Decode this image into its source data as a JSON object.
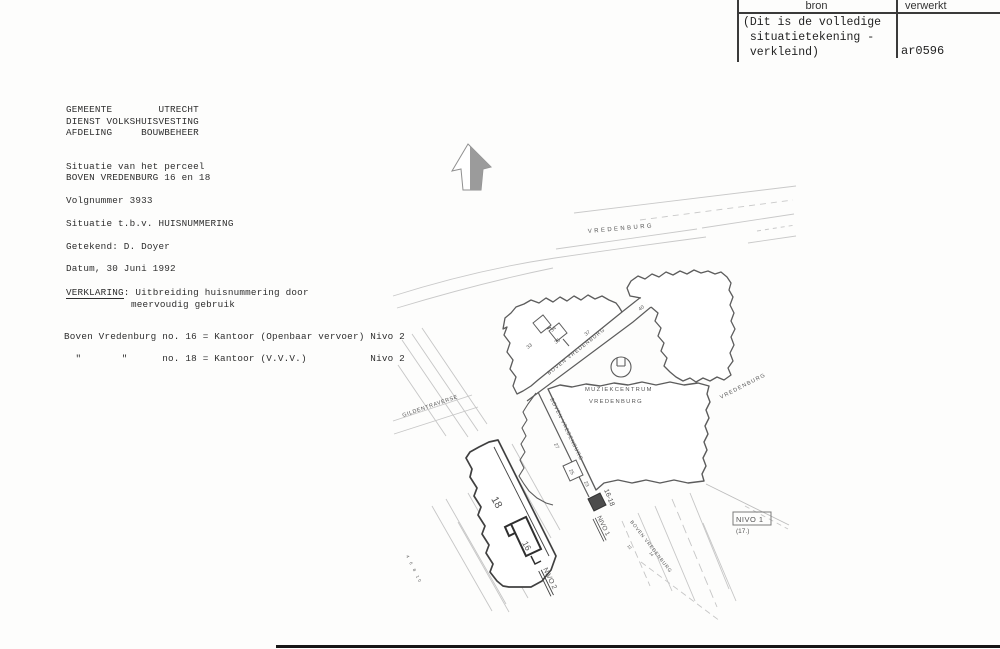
{
  "stamp": {
    "col1": "bron",
    "col2": "verwerkt",
    "note1": "(Dit is de volledige",
    "note2": " situatietekening -",
    "note3": " verkleind)",
    "code": "ar0596"
  },
  "text": {
    "lh1": "GEMEENTE        UTRECHT",
    "lh2": "DIENST VOLKSHUISVESTING",
    "lh3": "AFDELING     BOUWBEHEER",
    "situatie1": "Situatie van het perceel",
    "situatie2": "BOVEN VREDENBURG 16 en 18",
    "volgnummer": "Volgnummer 3933",
    "tbv": "Situatie t.b.v. HUISNUMMERING",
    "getekend": "Getekend: D. Doyer",
    "datum": "Datum, 30 Juni 1992",
    "verklaring_label": "VERKLARING",
    "verklaring_rest": ": Uitbreiding huisnummering door",
    "verklaring2": "meervoudig gebruik",
    "entry16": "Boven Vredenburg no. 16 = Kantoor (Openbaar vervoer) Nivo 2",
    "entry18": "  \"       \"      no. 18 = Kantoor (V.V.V.)           Nivo 2"
  },
  "map": {
    "street_top": "VREDENBURG",
    "street_right": "VREDENBURG",
    "street_gilden": "GILDENTRAVERSE",
    "street_boven_upper": "BOVEN  VREDENBURG",
    "street_boven_lower": "BOVEN  VREDENBURG",
    "street_boven_se": "BOVEN  VREDENBURG",
    "building_line1": "MUZIEKCENTRUM",
    "building_line2": "VREDENBURG",
    "nivo1_box": "NIVO 1",
    "nivo1_box_sub": "(17.)",
    "nivo1_rotated": "NIVO 1",
    "nivo2_rotated": "NIVO 2",
    "entrance_label": "16-18",
    "num18": "18",
    "num16": "16",
    "num33": "33",
    "num34": "34",
    "num35": "35",
    "num37": "37",
    "num40": "40",
    "num27": "27",
    "num25": "25",
    "num23": "23",
    "num12": "12",
    "num14": "14",
    "tiny_nums": "4 6 8 10"
  },
  "colors": {
    "ink": "#2e2e2e",
    "drawing_line": "#5c5c5c",
    "faint_line": "#c6c6c6"
  }
}
